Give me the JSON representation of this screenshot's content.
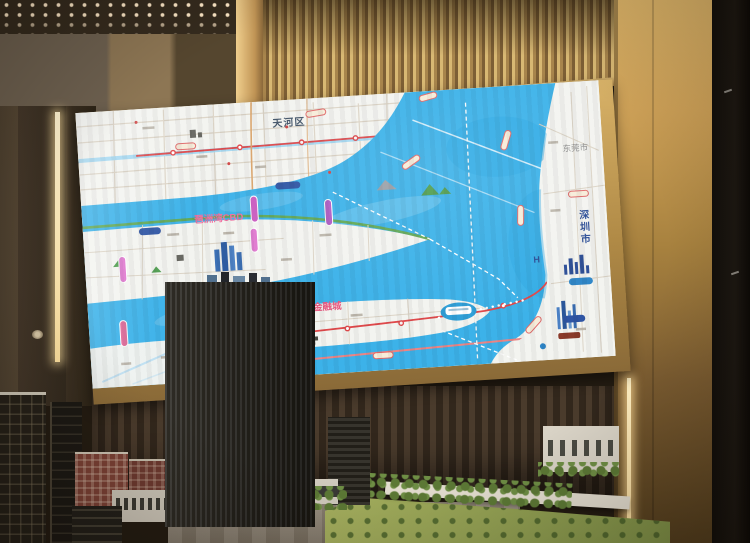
{
  "scene": {
    "description": "Real-estate sales center photo: a large gold-framed LED wall screen displays a regional transit map of the Pazhou Bay / Pearl River area, above a physical architectural scale model with a dark striped skyscraper, brick mid-rises, plaza, trees and lawn."
  },
  "screen_map": {
    "labels": {
      "district": "天河区",
      "bay_cbd": "琶洲湾CBD",
      "financial_city": "国际金融城",
      "dongguan": "东莞市",
      "shenzhen": "深圳市",
      "hospital_marker": "H"
    },
    "colors": {
      "water": "#3cb2e9",
      "water_deep": "#2ba6e2",
      "land": "#f3f4f0",
      "park_green": "#63a84f",
      "metro_red": "#e0484a",
      "metro_pink_pill": "#e07ad0",
      "road_light_blue": "#a6d9f2",
      "road_tan": "#dcd4c6",
      "label_pink": "#f06f9f",
      "label_dark_blue": "#2c4e97"
    }
  },
  "environment": {
    "colors": {
      "gold_slats": "#c2a05e",
      "frame_gold": "#caa55e",
      "wall_dark_brown": "#4a3b2c",
      "led_strip_warm": "#ffeec2",
      "model_tower_dark": "#232019",
      "brick_red": "#7d4236",
      "lawn_green": "#94a454"
    }
  }
}
